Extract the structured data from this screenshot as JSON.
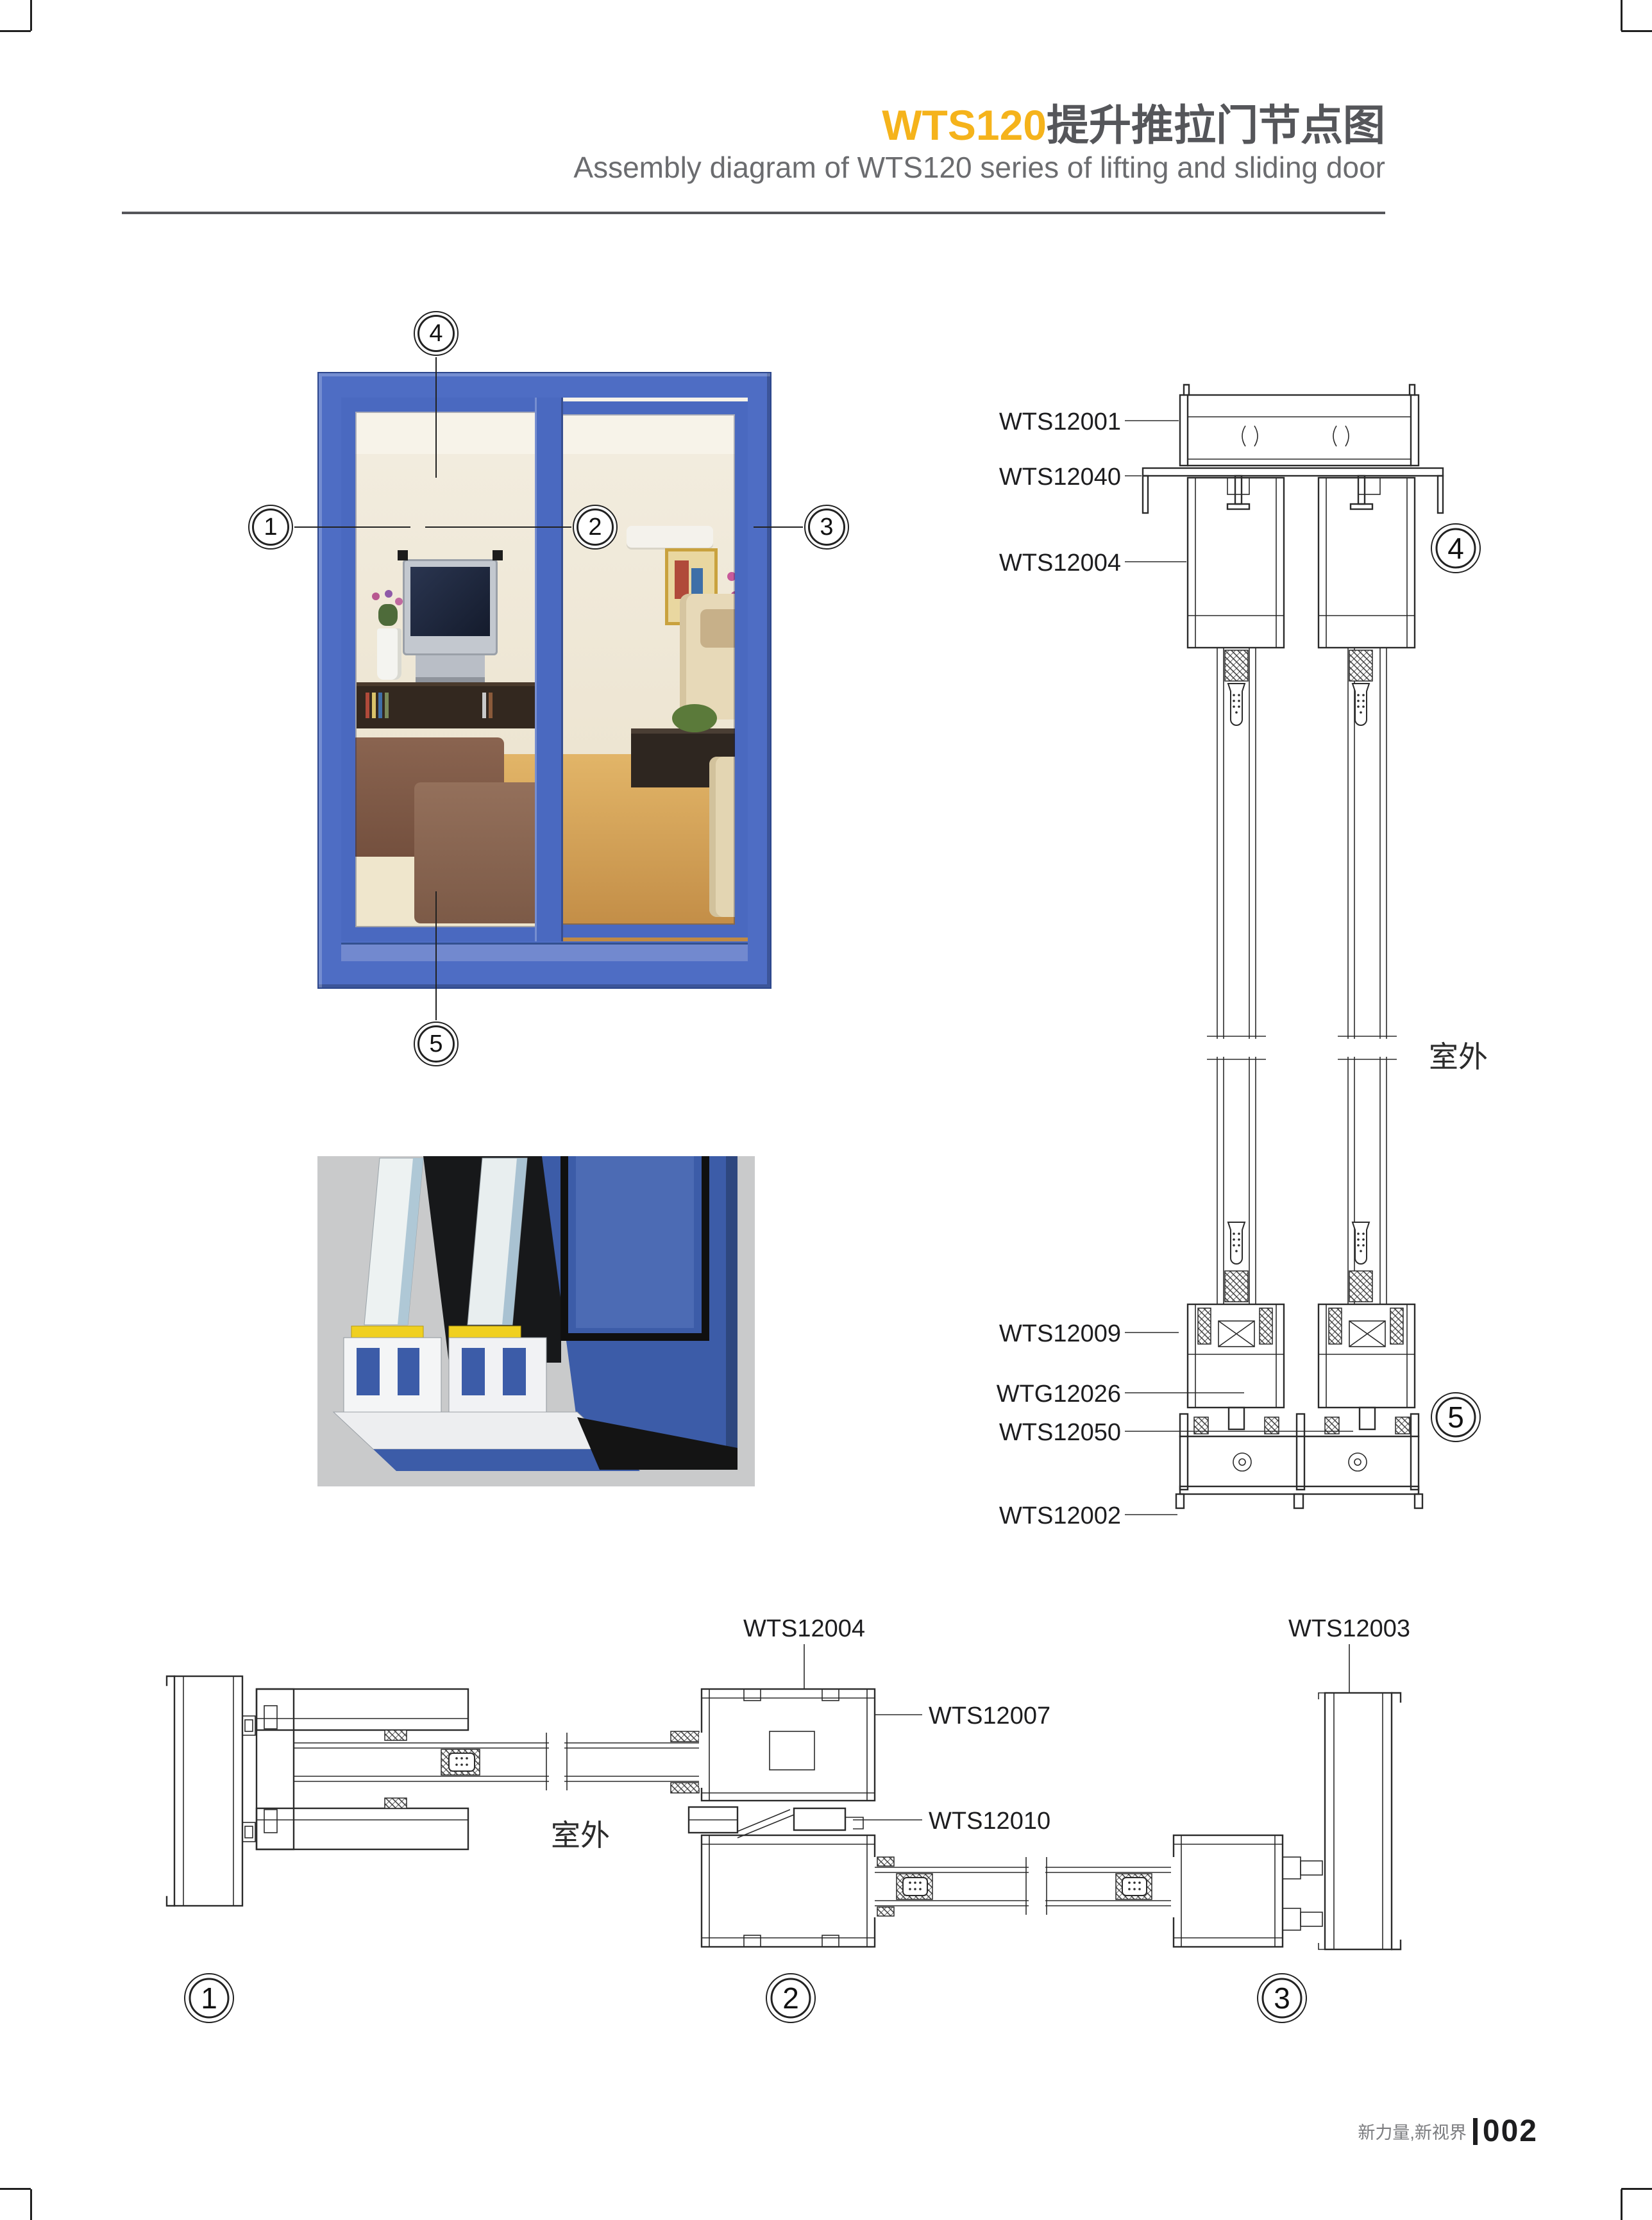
{
  "header": {
    "title_highlight": "WTS120",
    "title_rest": "提升推拉门节点图",
    "subtitle": "Assembly diagram of WTS120 series of lifting and sliding door",
    "accent_color": "#F5B31B",
    "title_color": "#55565A"
  },
  "photo": {
    "callouts": [
      "1",
      "2",
      "3",
      "4",
      "5"
    ]
  },
  "vertical_section": {
    "labels": [
      {
        "text": "WTS12001"
      },
      {
        "text": "WTS12040"
      },
      {
        "text": "WTS12004"
      },
      {
        "text": "WTS12009"
      },
      {
        "text": "WTG12026"
      },
      {
        "text": "WTS12050"
      },
      {
        "text": "WTS12002"
      }
    ],
    "callout_top": "4",
    "callout_bottom": "5",
    "outdoor": "室外"
  },
  "horizontal_section": {
    "labels": [
      {
        "text": "WTS12004"
      },
      {
        "text": "WTS12007"
      },
      {
        "text": "WTS12010"
      },
      {
        "text": "WTS12003"
      }
    ],
    "callouts": [
      "1",
      "2",
      "3"
    ],
    "outdoor": "室外"
  },
  "footer": {
    "slogan": "新力量,新视界",
    "page": "002"
  },
  "colors": {
    "accent_yellow": "#F5B31B",
    "door_frame_blue": "#4A69C0",
    "render_blue": "#3C5CA8"
  }
}
